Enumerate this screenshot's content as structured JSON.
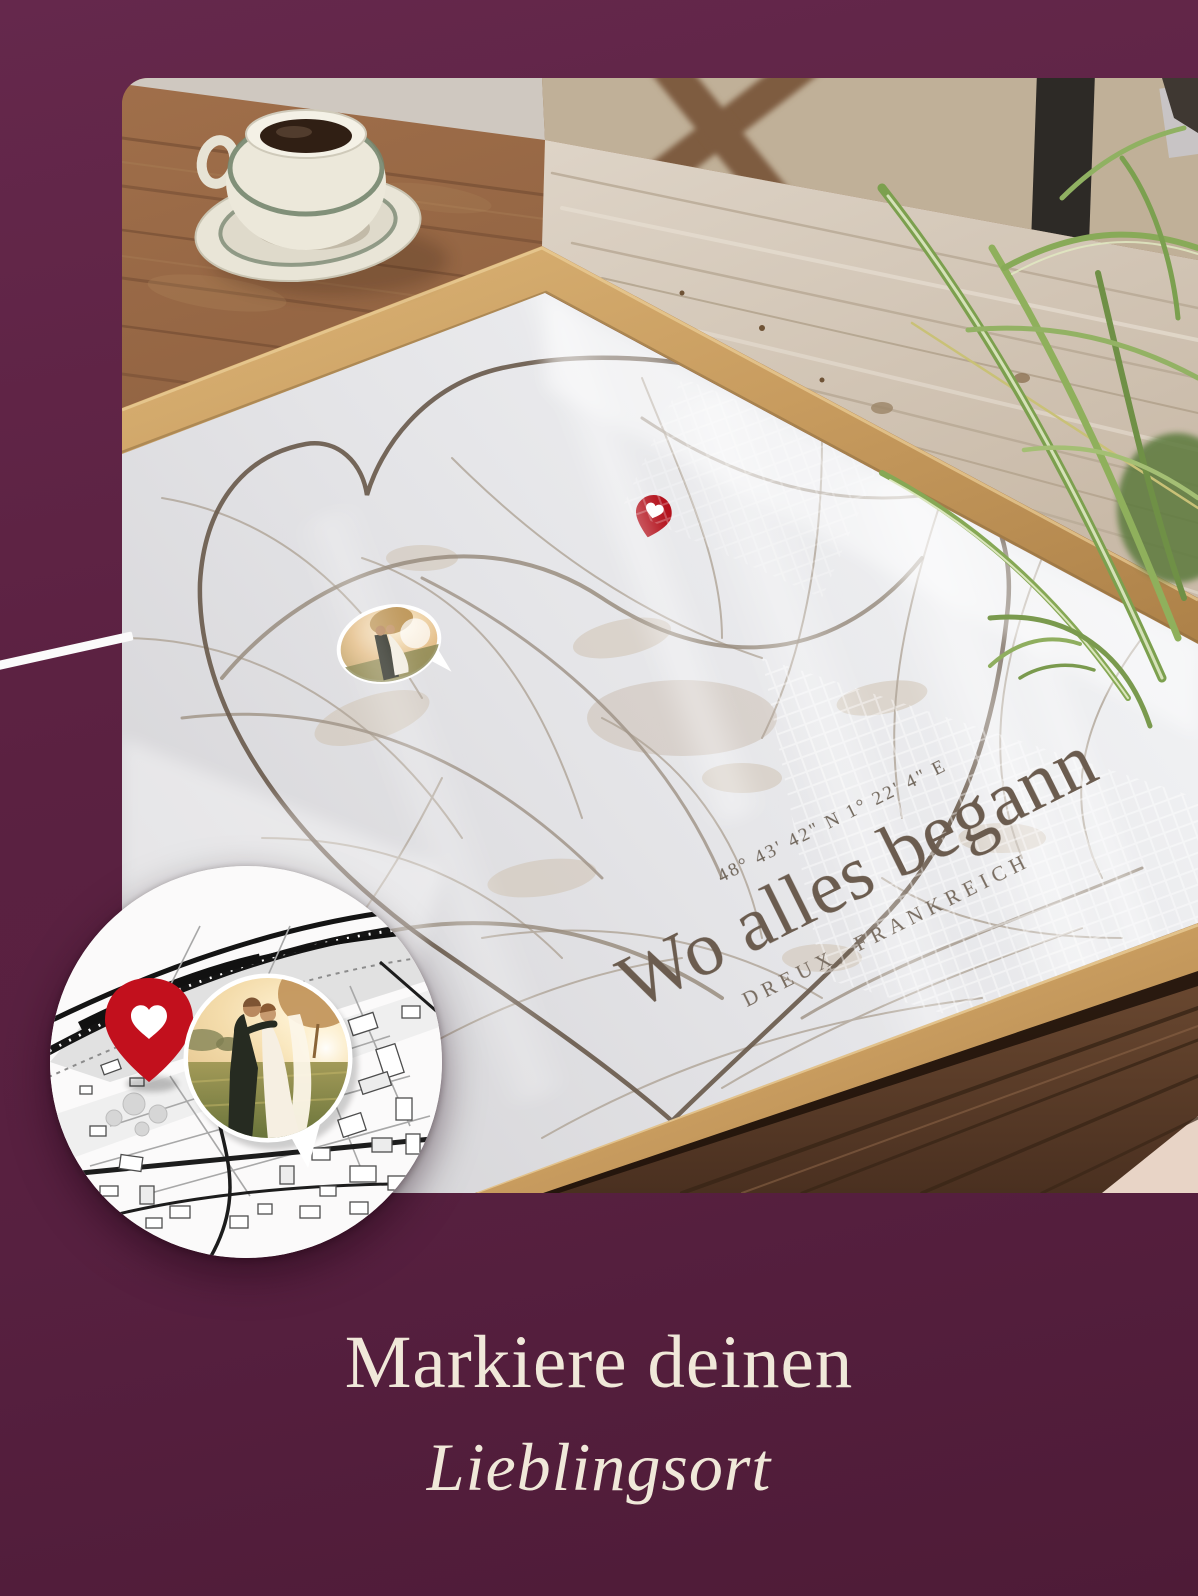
{
  "theme": {
    "background_color": "#5b2141",
    "accent_red": "#c2101d",
    "caption_color": "#f0e8d9",
    "poster_text_color": "#6b5d50",
    "frame_wood_color": "#c89c5f",
    "paper_color": "#e9eaec"
  },
  "poster": {
    "coordinates": "48° 43' 42\" N 1° 22' 4\" E",
    "title": "Wo alles begann",
    "location": "DREUX, FRANKREICH"
  },
  "caption": {
    "line1": "Markiere deinen",
    "line2": "Lieblingsort"
  },
  "icons": {
    "poster_pin": "heart-location-pin",
    "badge_pin": "heart-location-pin",
    "badge_photo": "couple-wedding-photo",
    "poster_photo_chip": "couple-wedding-photo"
  }
}
